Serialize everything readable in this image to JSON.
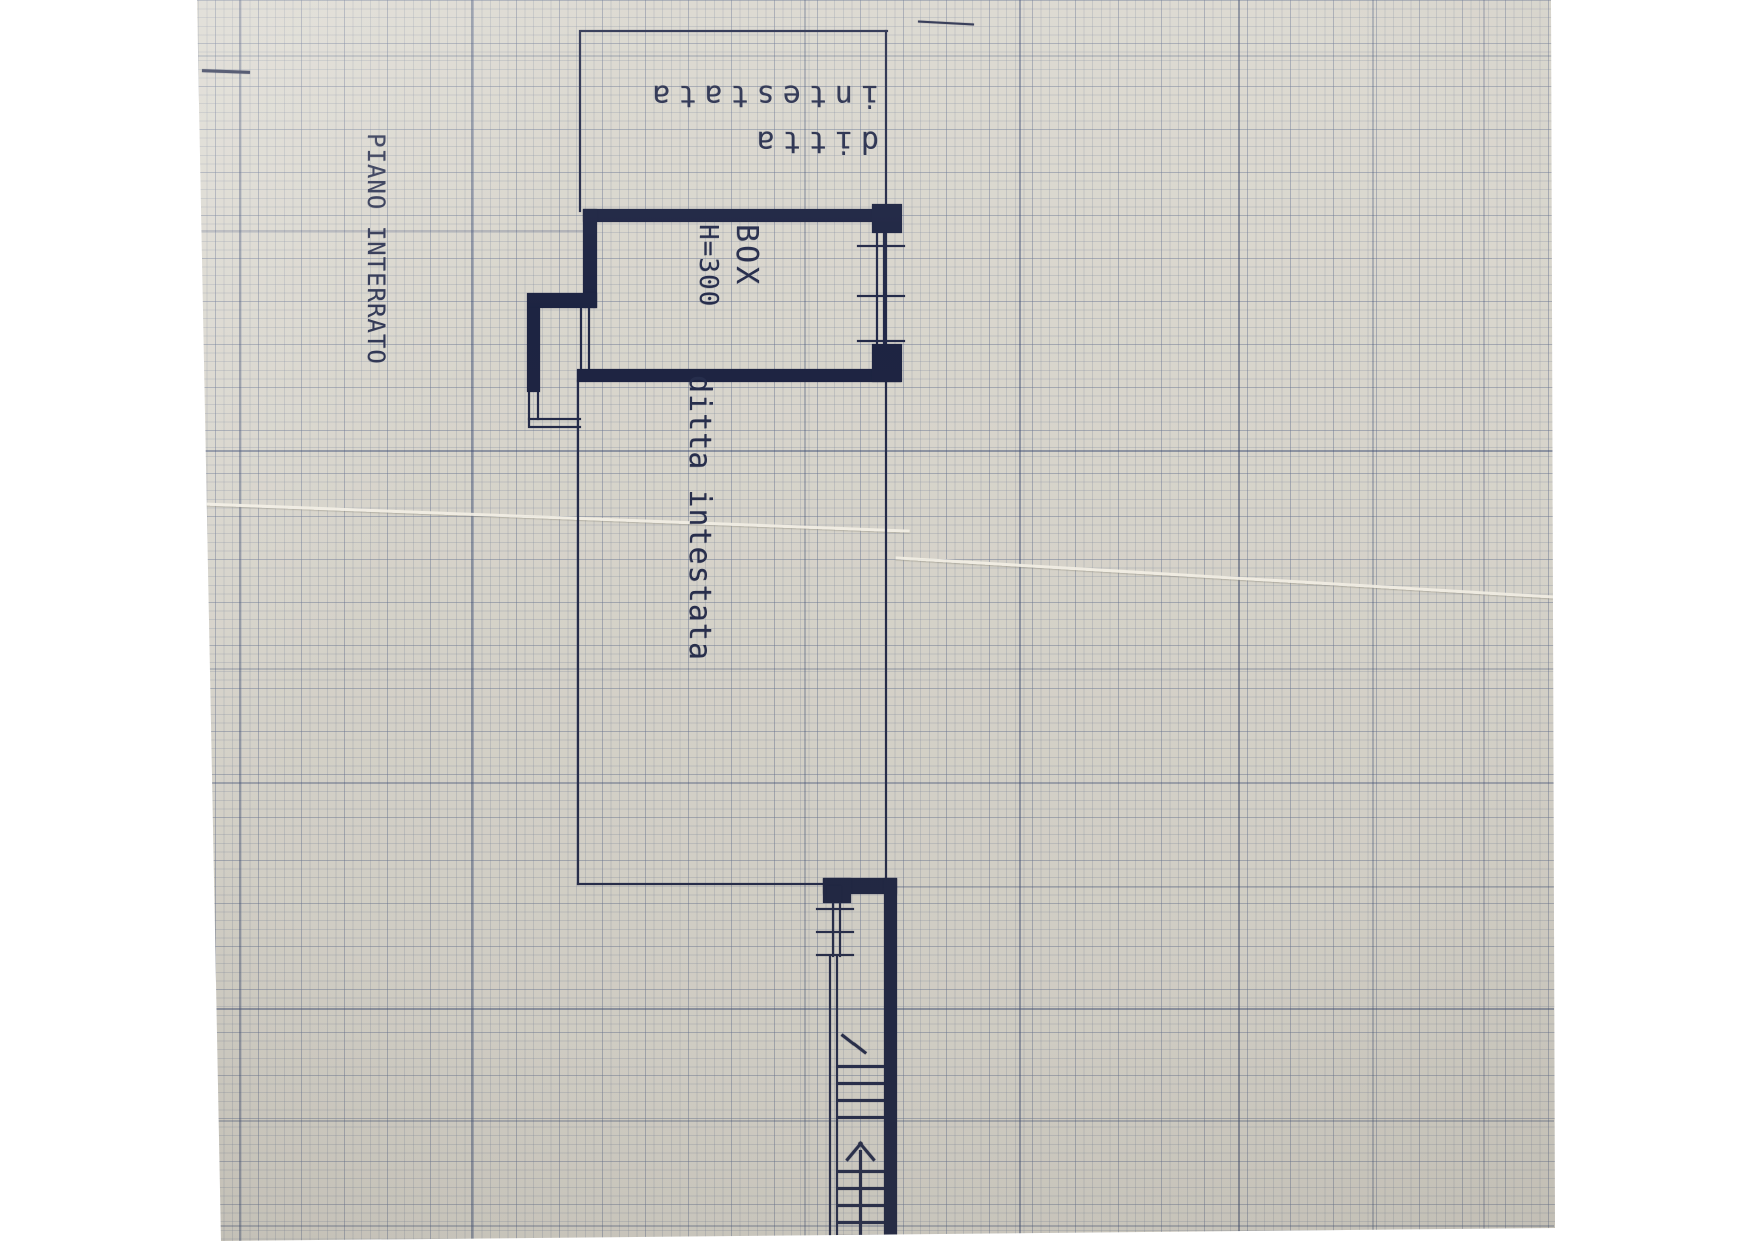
{
  "labels": {
    "floor_title": "PIANO INTERRATO",
    "room_name": "BOX",
    "room_height": "H=300",
    "header_line1": "ditta",
    "header_line2": "intestata",
    "side_note": "ditta intestata"
  },
  "colors": {
    "paper": "#d9d6cd",
    "ink": "#1d2442",
    "grid_heavy": "#3c4c72",
    "grid_fine": "#8e99ad",
    "text_ink": "#262d4c"
  }
}
